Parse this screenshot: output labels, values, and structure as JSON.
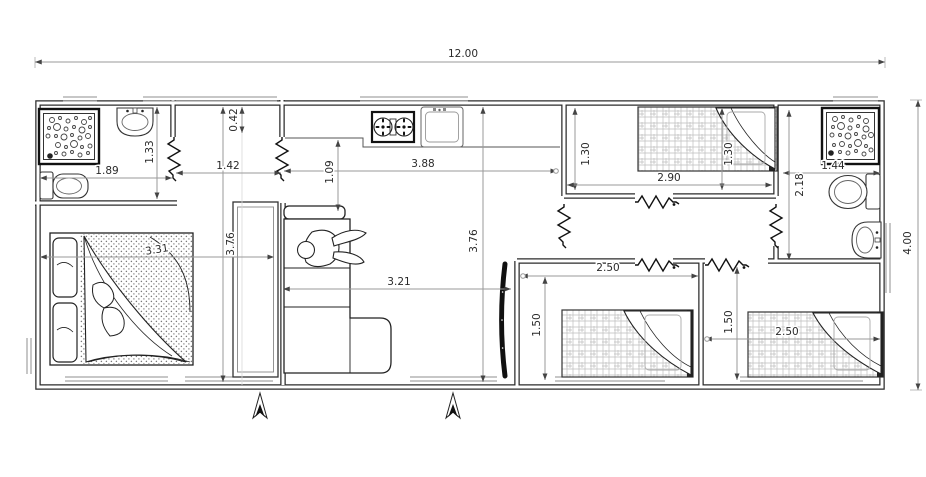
{
  "colors": {
    "wall_line": "#2b2b2b",
    "fixture_line": "#333333",
    "dimension_line": "#9a9a9a",
    "dimension_text": "#2a2a2a",
    "bed_hatch": "#b8b8b8",
    "background": "#ffffff"
  },
  "dims": {
    "total_width": "12.00",
    "total_depth": "4.00",
    "bath1_width": "1.89",
    "bath1_depth": "1.33",
    "entry_offset": "0.42",
    "hall_width": "1.42",
    "kitchen_counter_offset": "1.09",
    "kitchen_width": "3.88",
    "bedroom1_depth": "3.76",
    "bedroom1_bed_width": "3.31",
    "living_depth": "3.76",
    "living_width": "3.21",
    "bedroom2_depth_left": "1.30",
    "bedroom2_depth_right": "1.30",
    "bedroom2_width": "2.90",
    "bath2_width": "1.44",
    "bath2_depth": "2.18",
    "bedroom3_width": "2.50",
    "bedroom3_depth": "1.50",
    "bedroom4_depth": "1.50",
    "bedroom4_width": "2.50"
  },
  "fixtures": [
    "shower-icon",
    "washbasin-icon",
    "toilet-icon",
    "double-bed-icon",
    "single-bed-icon",
    "wardrobe-icon",
    "sofa-icon",
    "person-icon",
    "cooktop-icon",
    "kitchen-sink-icon",
    "tv-icon",
    "door-break-icon",
    "north-arrow-icon"
  ]
}
